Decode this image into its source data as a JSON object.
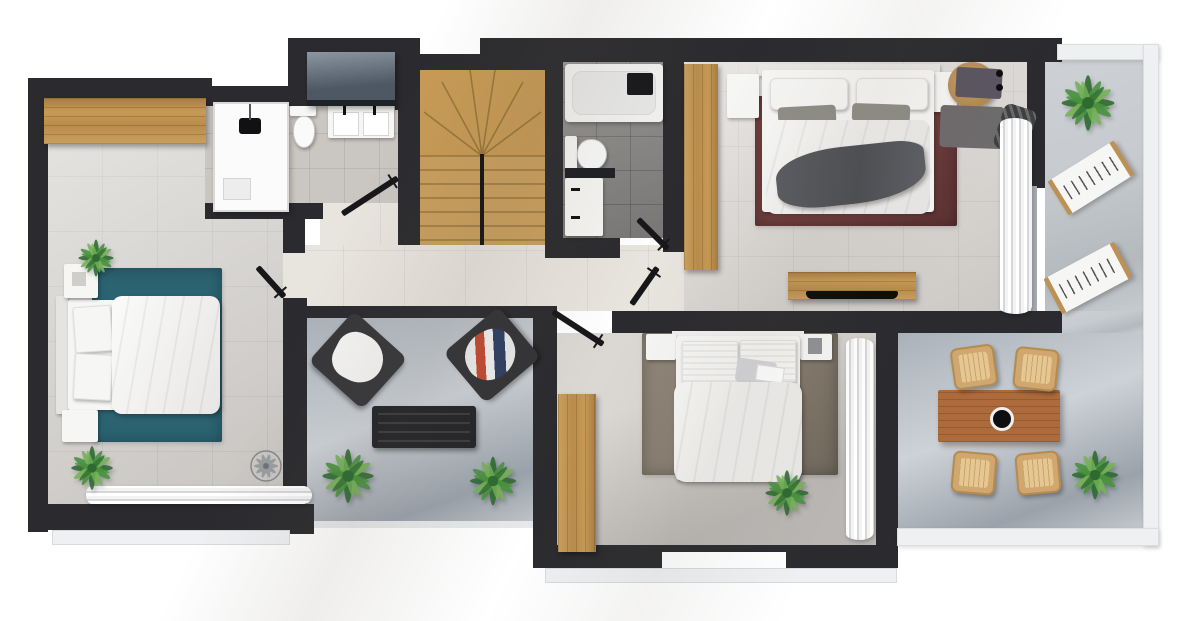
{
  "scene": {
    "type": "3d-floor-plan-top-down-render",
    "background": "#ffffff",
    "text_visible": false
  },
  "palette": {
    "wall": "#2b2b2f",
    "wallDark": "#1f1f23",
    "floorWarm": "#d8d4d0",
    "floorHall": "#e8e4de",
    "floorBath": "#cac6c1",
    "floorBathDark": "#8d8b89",
    "floorTerrace": "#c7cbcf",
    "floorDining": "#aab1b9",
    "wood": "#bd9154",
    "stairWood": "#c99f5e",
    "tableWood": "#ad6b3c",
    "wicker": "#d0a76f",
    "rugTeal": "#2b6371",
    "rugMaroon": "#6b3a3a",
    "rugTaupe": "#867c6f",
    "furnWhite": "#f6f6f4",
    "throwGrey": "#54565b",
    "counterDark": "#1d1f23",
    "cabinetSlate": "#5d6875",
    "plantDark": "#2f6b31",
    "plantMid": "#48923f",
    "plantLight": "#74b357",
    "parapet": "#eff0f2",
    "sill": "#eef0f2",
    "glass": "#a7acb1"
  },
  "rooms": [
    {
      "name": "bedroom-left",
      "furniture": [
        "wood-wardrobe",
        "double-bed",
        "nightstand",
        "nightstand",
        "teal-rug",
        "potted-plant",
        "potted-plant",
        "ceiling-fan",
        "window-curtains"
      ]
    },
    {
      "name": "bathroom-main",
      "furniture": [
        "walk-in-shower",
        "toilet",
        "double-sink-vanity",
        "slate-laundry-cabinet"
      ]
    },
    {
      "name": "staircase",
      "furniture": [
        "u-shaped-wood-stairs",
        "center-rail"
      ]
    },
    {
      "name": "bathroom-ensuite",
      "furniture": [
        "bathtub",
        "toilet",
        "sink-vanity"
      ]
    },
    {
      "name": "bedroom-master",
      "furniture": [
        "wood-wardrobe",
        "double-bed",
        "grey-throw",
        "maroon-rug",
        "nightstand",
        "nightstand",
        "round-desk",
        "desk-chair",
        "tv-console",
        "curtains"
      ]
    },
    {
      "name": "terrace-upper",
      "furniture": [
        "palm-plant",
        "sun-lounger",
        "sun-lounger"
      ]
    },
    {
      "name": "hallway",
      "furniture": [
        "open-door",
        "open-door",
        "open-door",
        "open-door",
        "open-door"
      ]
    },
    {
      "name": "lounge-balcony",
      "furniture": [
        "armchair-white-blanket",
        "armchair-striped-blanket",
        "slatted-coffee-table",
        "potted-plant",
        "potted-plant"
      ]
    },
    {
      "name": "bedroom-middle",
      "furniture": [
        "double-bed",
        "nightstand",
        "nightstand",
        "taupe-rug",
        "wood-wardrobe",
        "potted-plant",
        "curtains",
        "sliding-window"
      ]
    },
    {
      "name": "terrace-dining",
      "furniture": [
        "wood-dining-table",
        "wicker-chair",
        "wicker-chair",
        "wicker-chair",
        "wicker-chair",
        "potted-plant"
      ]
    }
  ]
}
